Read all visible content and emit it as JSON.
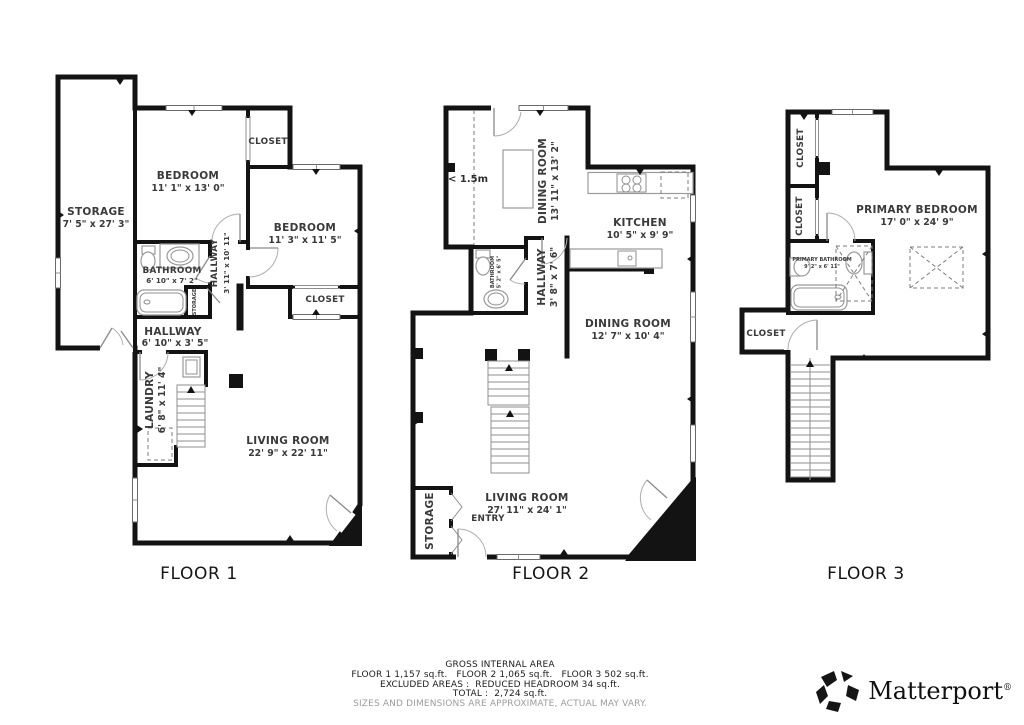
{
  "floor1": {
    "title": "FLOOR 1",
    "rooms": {
      "storage": {
        "name": "STORAGE",
        "dims": "7' 5\" x 27' 3\""
      },
      "bedroom1": {
        "name": "BEDROOM",
        "dims": "11' 1\" x 13' 0\""
      },
      "closet1": {
        "name": "CLOSET"
      },
      "bedroom2": {
        "name": "BEDROOM",
        "dims": "11' 3\" x 11' 5\""
      },
      "bathroom": {
        "name": "BATHROOM",
        "dims": "6' 10\" x 7' 2\""
      },
      "hallway_vertical": {
        "name": "HALLWAY",
        "dims": "3' 11\" x 10' 11\""
      },
      "storage_closet": {
        "name": "STORAGE"
      },
      "closet2": {
        "name": "CLOSET"
      },
      "hallway": {
        "name": "HALLWAY",
        "dims": "6' 10\" x 3' 5\""
      },
      "laundry": {
        "name": "LAUNDRY",
        "dims": "6' 8\" x 11' 4\""
      },
      "living_room": {
        "name": "LIVING ROOM",
        "dims": "22' 9\" x 22' 11\""
      }
    }
  },
  "floor2": {
    "title": "FLOOR 2",
    "annotation_headroom": "< 1.5m",
    "rooms": {
      "dining_room_upper": {
        "name": "DINING ROOM",
        "dims": "13' 11\" x 13' 2\""
      },
      "kitchen": {
        "name": "KITCHEN",
        "dims": "10' 5\" x 9' 9\""
      },
      "bathroom": {
        "name": "BATHROOM",
        "dims": "5' 2\" x 6' 5\""
      },
      "hallway": {
        "name": "HALLWAY",
        "dims": "3' 8\" x 7' 6\""
      },
      "dining_room_lower": {
        "name": "DINING ROOM",
        "dims": "12' 7\" x 10' 4\""
      },
      "living_room": {
        "name": "LIVING ROOM",
        "dims": "27' 11\" x 24' 1\""
      },
      "storage": {
        "name": "STORAGE"
      },
      "entry": {
        "name": "ENTRY"
      }
    }
  },
  "floor3": {
    "title": "FLOOR 3",
    "rooms": {
      "closet_upper": {
        "name": "CLOSET"
      },
      "closet_middle": {
        "name": "CLOSET"
      },
      "primary_bedroom": {
        "name": "PRIMARY BEDROOM",
        "dims": "17' 0\" x 24' 9\""
      },
      "primary_bathroom": {
        "name": "PRIMARY BATHROOM",
        "dims": "9' 2\" x 6' 11\""
      },
      "closet_lower": {
        "name": "CLOSET"
      }
    }
  },
  "footer": {
    "title": "GROSS INTERNAL AREA",
    "floor_areas": "FLOOR 1 1,157 sq.ft.   FLOOR 2 1,065 sq.ft.   FLOOR 3 502 sq.ft.",
    "excluded": "EXCLUDED AREAS :  REDUCED HEADROOM 34 sq.ft.",
    "total": "TOTAL :  2,724 sq.ft.",
    "disclaimer": "SIZES AND DIMENSIONS ARE APPROXIMATE, ACTUAL MAY VARY."
  },
  "brand": {
    "name": "Matterport",
    "registered": "®"
  }
}
